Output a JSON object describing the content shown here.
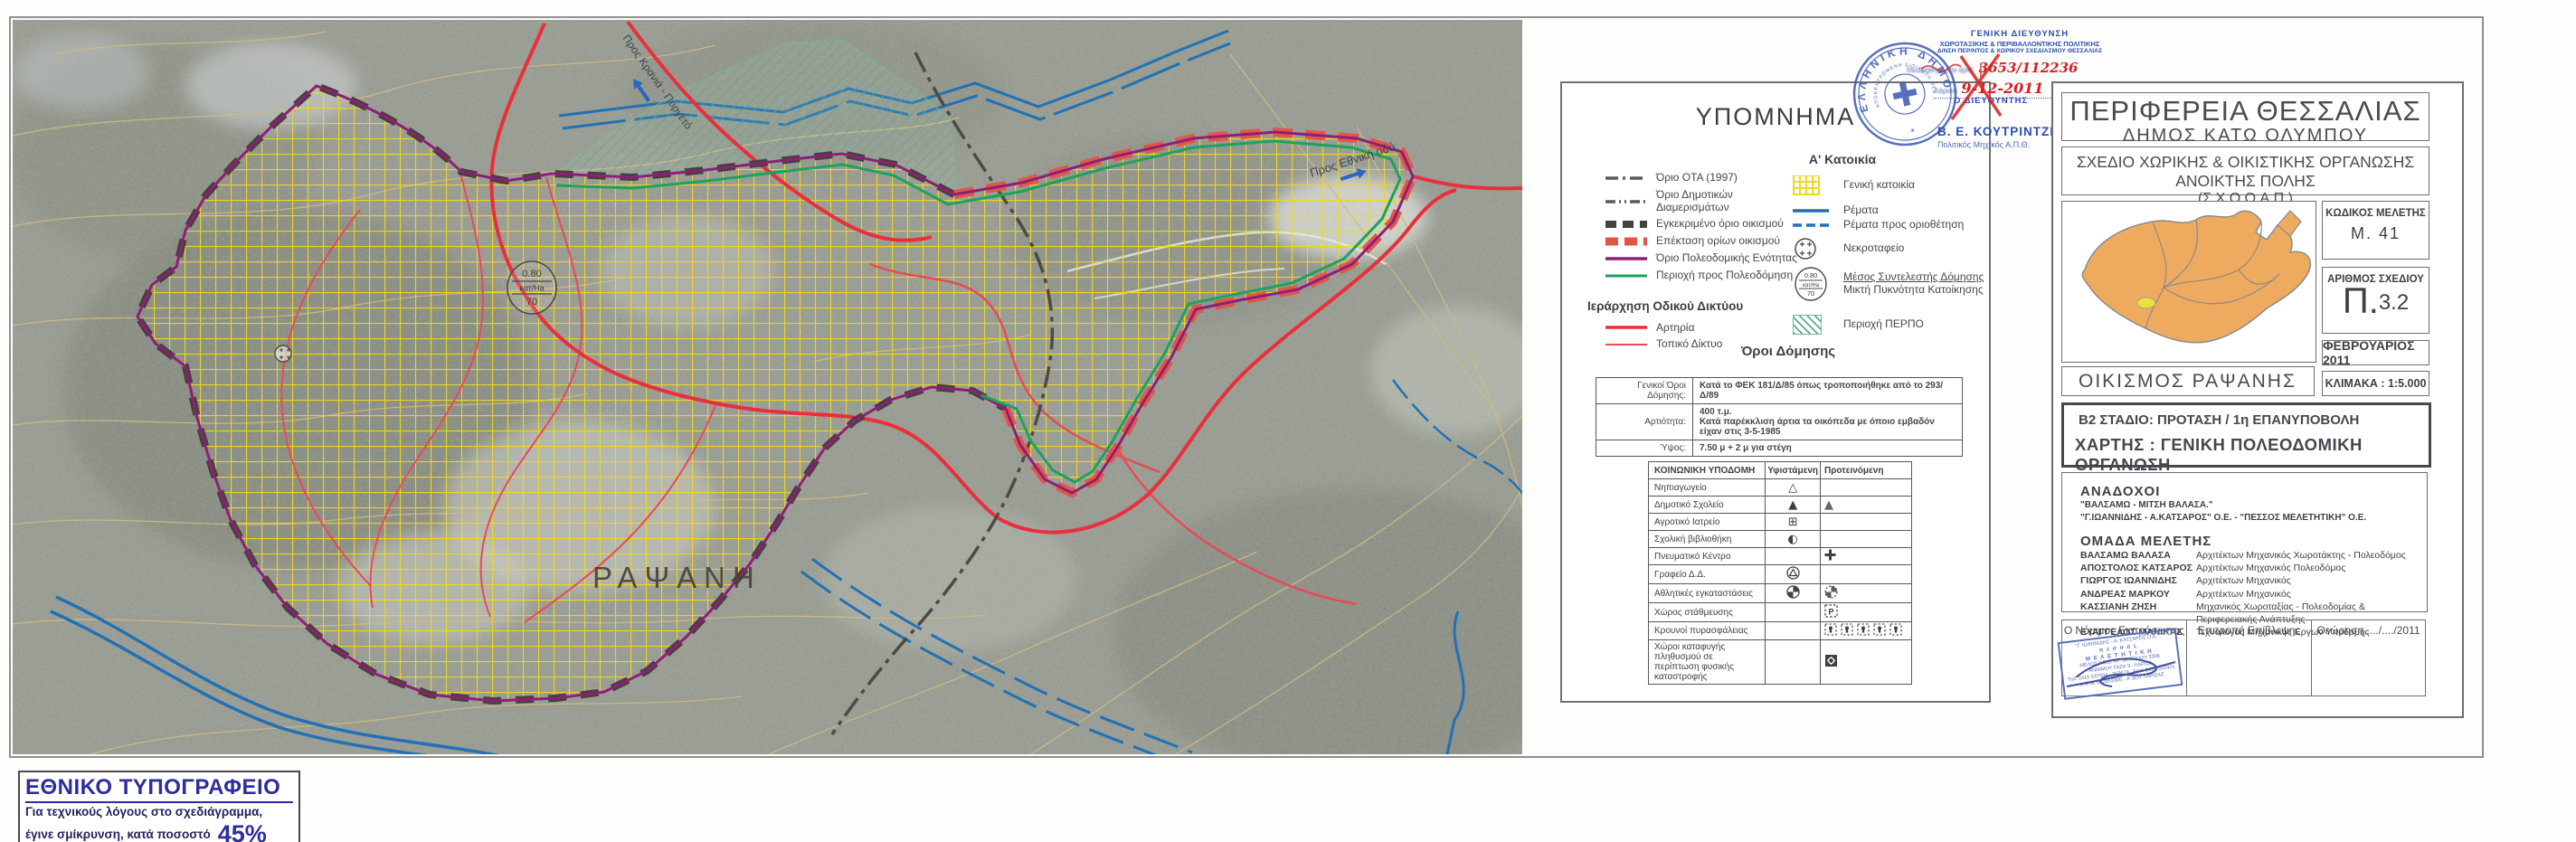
{
  "colors": {
    "artery_red": "#ea2f3c",
    "local_road_red": "#e84b57",
    "stream_blue": "#2071b5",
    "boundary_purple": "#8e1f78",
    "approved_boundary_gray": "#45413c",
    "extension_boundary_red": "#e25648",
    "to_plan_green": "#1ea25e",
    "housing_grid_yellow": "#eed820",
    "perpo_green": "#5aab8e",
    "contour_tan": "#cdbb82",
    "stamp_blue": "#2a4fae",
    "handwriting_red": "#d62020",
    "national_press_blue": "#2d2d9f"
  },
  "density_symbol": {
    "csd": "0.80",
    "unit": "κατ/Ha",
    "density": "70"
  },
  "map": {
    "settlement_label": "ΡΑΨΑΝΗ",
    "road_label_east": "Προς Εθνική οδό",
    "road_label_north": "Προς Κρανιά - Πυργετό"
  },
  "approval_stamp": {
    "dept_line1": "ΓΕΝΙΚΗ  ΔΙΕΥΘΥΝΣΗ",
    "dept_line2": "ΧΩΡΟΤΑΞΙΚΗΣ & ΠΕΡΙΒΑΛΛΟΝΤΙΚΗΣ ΠΟΛΙΤΙΚΗΣ",
    "dept_line3": "Δ/ΝΣΗ ΠΕΡ/ΝΤΟΣ & ΧΩΡΙΚΟΥ ΣΧΕΔΙΑΣΜΟΥ ΘΕΣΣΑΛΙΑΣ",
    "protocol_label": "Θεωρήθηκε την   αριθ.",
    "protocol_number": "3653/112236",
    "city_label": "Λάρισα",
    "date_handwritten": "9-12-2011",
    "director_label": "Ο ΔΙΕΥΘΥΝΤΗΣ",
    "director_name": "Β. Ε. ΚΟΥΤΡΙΝΤΖΕΣ",
    "director_title": "Πολιτικός  Μηχ/κός  Α.Π.Θ.",
    "seal_outer": "ΕΛΛΗΝΙΚΗ ΔΗΜΟΚΡΑΤΙΑ",
    "seal_inner": "ΑΠΟΚΕΝΤΡΩΜΕΝΗ ΔΙΟΙΚΗΣΗ ΘΕΣΣΑΛΙΑΣ - ΣΤΕΡΕΑΣ ΕΛΛΑΔΑΣ"
  },
  "legend": {
    "title": "ΥΠΟΜΝΗΜΑ",
    "housing_heading": "Α' Κατοικία",
    "left_items": [
      {
        "label": "Όριο ΟΤΑ (1997)",
        "swatch": "gray-dashdot-line"
      },
      {
        "label": "Όριο Δημοτικών Διαμερισμάτων",
        "swatch": "gray-dashdotdot-line"
      },
      {
        "label": "Εγκεκριμένο όριο οικισμού",
        "swatch": "dark-block-dash-line"
      },
      {
        "label": "Επέκταση ορίων οικισμού",
        "swatch": "red-block-dash-line"
      },
      {
        "label": "Όριο Πολεοδομικής Ενότητας",
        "swatch": "purple-solid-line"
      },
      {
        "label": "Περιοχή προς Πολεοδόμηση",
        "swatch": "green-solid-line"
      }
    ],
    "road_heading": "Ιεράρχηση Οδικού Δικτύου",
    "road_items": [
      {
        "label": "Αρτηρία",
        "swatch": "thick-red-line"
      },
      {
        "label": "Τοπικό Δίκτυο",
        "swatch": "thin-red-line"
      }
    ],
    "right_items": [
      {
        "label": "Γενική κατοικία",
        "swatch": "yellow-grid"
      },
      {
        "label": "Ρέματα",
        "swatch": "blue-solid-line"
      },
      {
        "label": "Ρέματα προς οριοθέτηση",
        "swatch": "blue-dashed-line"
      },
      {
        "label": "Νεκροταφείο",
        "swatch": "cemetery-circle"
      }
    ],
    "density_item": {
      "line1": "Μέσος Συντελεστής Δόμησης",
      "line2": "Μικτή Πυκνότητα Κατοίκησης"
    },
    "perpo_item": "Περιοχή ΠΕΡΠΟ",
    "terms": {
      "heading": "Όροι Δόμησης",
      "row1_label": "Γενικοί Όροι Δόμησης:",
      "row1_value": "Κατά το ΦΕΚ 181/Δ/85 όπως τροποποιήθηκε από το 293/Δ/89",
      "row2_label": "Αρτιότητα:",
      "row2_value_line1": "400 τ.μ.",
      "row2_value_line2": "Κατά παρέκκλιση άρτια τα οικόπεδα με όποιο εμβαδόν είχαν στις 3-5-1985",
      "row3_label": "Ύψος:",
      "row3_value": "7.50 μ  + 2 μ  για στέγη"
    },
    "infra": {
      "col1": "ΚΟΙΝΩΝΙΚΗ  ΥΠΟΔΟΜΗ",
      "col2": "Υφιστάμενη",
      "col3": "Προτεινόμενη",
      "parking_letter": "P",
      "rows": [
        {
          "label": "Νηπιαγωγείο",
          "existing_icon": "triangle-outline",
          "proposed_icon": ""
        },
        {
          "label": "Δημοτικό Σχολείο",
          "existing_icon": "triangle-filled",
          "proposed_icon": "triangle-filled-dashed"
        },
        {
          "label": "Αγροτικό Ιατρείο",
          "existing_icon": "square-cross",
          "proposed_icon": ""
        },
        {
          "label": "Σχολική βιβλιοθήκη",
          "existing_icon": "half-filled-circle",
          "proposed_icon": ""
        },
        {
          "label": "Πνευματικό Κέντρο",
          "existing_icon": "",
          "proposed_icon": "bold-cross"
        },
        {
          "label": "Γραφείο Δ.Δ.",
          "existing_icon": "circle-triangle",
          "proposed_icon": ""
        },
        {
          "label": "Αθλητικές εγκαταστάσεις",
          "existing_icon": "quartered-circle",
          "proposed_icon": "quartered-circle-dashed"
        },
        {
          "label": "Χώρος στάθμευσης",
          "existing_icon": "",
          "proposed_icon": "parking-square"
        },
        {
          "label": "Κρουνοί πυρασφάλειας",
          "existing_icon": "",
          "proposed_icon": "hydrant-squares-x5"
        },
        {
          "label": "Χώροι καταφυγής πληθυσμού σε περίπτωση φυσικής καταστροφής",
          "existing_icon": "",
          "proposed_icon": "refuge-square"
        }
      ]
    }
  },
  "title_block": {
    "region": "ΠΕΡΙΦΕΡΕΙΑ ΘΕΣΣΑΛΙΑΣ",
    "municipality": "ΔΗΜΟΣ  ΚΑΤΩ  ΟΛΥΜΠΟΥ",
    "plan_line1": "ΣΧΕΔΙΟ ΧΩΡΙΚΗΣ & ΟΙΚΙΣΤΙΚΗΣ ΟΡΓΑΝΩΣΗΣ ΑΝΟΙΚΤΗΣ ΠΟΛΗΣ",
    "plan_line2": "(Σ.Χ.Ο.Ο.Α.Π.)",
    "settlement": "ΟΙΚΙΣΜΟΣ  ΡΑΨΑΝΗΣ",
    "study_code_label": "ΚΩΔΙΚΟΣ ΜΕΛΕΤΗΣ",
    "study_code": "Μ.  41",
    "plan_no_label": "ΑΡΙΘΜΟΣ ΣΧΕΔΙΟΥ",
    "plan_no_prefix": "Π.",
    "plan_no": "3.2",
    "date": "ΦΕΒΡΟΥΑΡΙΟΣ 2011",
    "scale": "ΚΛΙΜΑΚΑ :  1:5.000",
    "stage": "Β2  ΣΤΑΔΙΟ: ΠΡΟΤΑΣΗ / 1η ΕΠΑΝΥΠΟΒΟΛΗ",
    "map_type": "ΧΑΡΤΗΣ : ΓΕΝΙΚΗ ΠΟΛΕΟΔΟΜΙΚΗ ΟΡΓΑΝΩΣΗ",
    "contractors_heading": "ΑΝΑΔΟΧΟΙ",
    "contractor1": "\"ΒΑΛΣΑΜΩ - ΜΙΤΣΗ  ΒΑΛΑΣΑ.\"",
    "contractor2": "\"Γ.ΙΩΑΝΝΙΔΗΣ - Α.ΚΑΤΣΑΡΟΣ\" Ο.Ε. - \"ΠΕΣΣΟΣ ΜΕΛΕΤΗΤΙΚΗ\"  Ο.Ε.",
    "team_heading": "ΟΜΑΔΑ ΜΕΛΕΤΗΣ",
    "team": [
      {
        "name": "ΒΑΛΣΑΜΩ ΒΑΛΑΣΑ",
        "role": "Αρχιτέκτων Μηχανικός  Χωροτάκτης - Πολεοδόμος"
      },
      {
        "name": "ΑΠΟΣΤΟΛΟΣ ΚΑΤΣΑΡΟΣ",
        "role": "Αρχιτέκτων Μηχανικός  Πολεοδόμος"
      },
      {
        "name": "ΓΙΩΡΓΟΣ ΙΩΑΝΝΙΔΗΣ",
        "role": "Αρχιτέκτων Μηχανικός"
      },
      {
        "name": "ΑΝΔΡΕΑΣ ΜΑΡΚΟΥ",
        "role": "Αρχιτέκτων Μηχανικός"
      },
      {
        "name": "ΚΑΣΣΙΑΝΗ ΖΗΣΗ",
        "role": "Μηχανικός Χωροταξίας - Πολεοδομίας & Περιφερειακής Ανάπτυξης"
      },
      {
        "name": "ΕΥΑΓΓΕΛΟΣ ΜΑΝΙΚΑΣ",
        "role": "Τεχνολόγος Μηχανικός Εργων Υποδομής"
      }
    ],
    "legal_rep": "Ο Νόμιμος Εκπρόσωπος",
    "committee": "Επιτροπή Επίβλεψης",
    "approval": "Θεώρηση  ..../..../2011",
    "pessos_stamp": [
      "\"Γ. ΙΩΑΝΝΙΔΗΣ - Α. ΚΑΤΣΑΡΟΣ Ο.Ε.\"",
      "π ε σ σ ό ς",
      "Μ Ε Λ Ε Τ Η Τ Ι Κ Η",
      "ΜΕΛΟΣ Τ.Ε.Ε.  ΑΡ. ΜΗΤΡΩΟΥ 3398",
      "ΑΝΘΙΜΟΥ ΓΑΖΗ 9 - ΛΑΡΙΣΑ",
      "Τηλ. 2410 537504 - 259678 , FAX. 2410 552421",
      "Α.Φ.Μ. 082853300 - Α' ΔΟΥ ΛΑΡΙΣΑΣ"
    ]
  },
  "footer_note": {
    "title": "ΕΘΝΙΚΟ ΤΥΠΟΓΡΑΦΕΙΟ",
    "line1": "Για τεχνικούς λόγους στο σχεδιάγραμμα,",
    "line2": "έγινε σμίκρυνση, κατά ποσοστό",
    "percent": "45%"
  }
}
